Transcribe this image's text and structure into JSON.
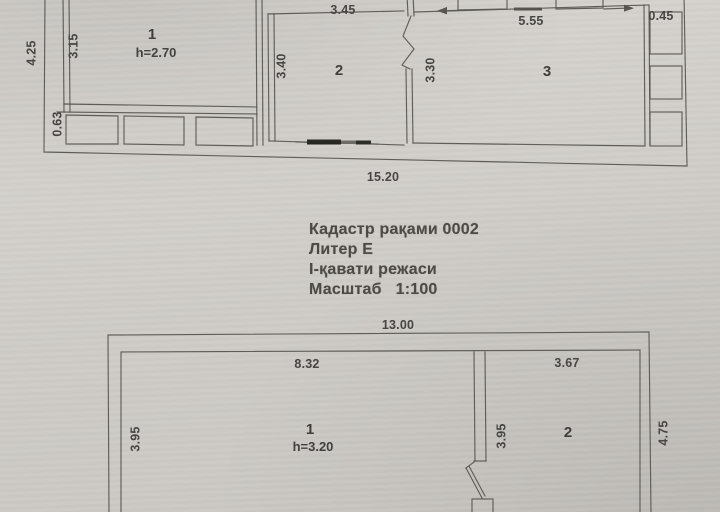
{
  "photo": {
    "title_block": {
      "cadastre_number": "Кадастр рақами 0002",
      "liter": "Литер Е",
      "floor_plan": "I-қавати режаси",
      "scale": "Масштаб   1:100"
    },
    "upper_plan": {
      "rooms": {
        "room1_number": "1",
        "room1_height": "h=2.70",
        "room2_number": "2",
        "room3_number": "3"
      },
      "dims": {
        "top_room2": "3.45",
        "top_room3": "5.55",
        "top_right": "0.45",
        "left_outer": "4.25",
        "left_inner": "3.15",
        "left_bottom": "0.63",
        "room2_left": "3.40",
        "room3_left": "3.30",
        "bottom_total": "15.20"
      }
    },
    "lower_plan": {
      "rooms": {
        "room1_number": "1",
        "room1_height": "h=3.20",
        "room2_number": "2"
      },
      "dims": {
        "top_total": "13.00",
        "top_room1": "8.32",
        "top_room2": "3.67",
        "room1_left": "3.95",
        "room2_left": "3.95",
        "right_outer": "4.75"
      }
    }
  }
}
